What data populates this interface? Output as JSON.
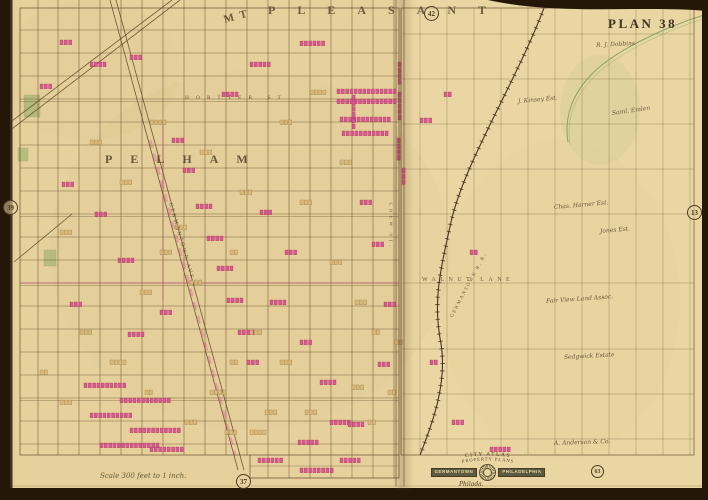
{
  "plate": {
    "number_label": "PLAN 38",
    "scale_note": "Scale 300 feet to 1 inch.",
    "imprint": "Philada.",
    "adjacent": {
      "top": "42",
      "left": "39",
      "right": "13",
      "bottom_left": "37",
      "bottom_right": "63"
    }
  },
  "districts": {
    "mt_prefix": "MT",
    "pleasant": "PLEASANT",
    "pelham": "PELHAM"
  },
  "cartouche": {
    "arch_top": "CITY ATLAS",
    "arch_bottom": "PROPERTY PLANS",
    "ribbon_left": "GERMANTOWN",
    "ribbon_right": "PHILADELPHIA"
  },
  "street_labels": [
    {
      "t": "HORTTER ST",
      "x": 185,
      "y": 95,
      "r": 0,
      "fs": 5.5,
      "ls": 7
    },
    {
      "t": "WALNUT LANE",
      "x": 422,
      "y": 277,
      "r": 0,
      "fs": 6,
      "ls": 4.5
    },
    {
      "t": "GERMANTOWN AVE.",
      "x": 170,
      "y": 200,
      "r": 74,
      "fs": 5.5,
      "ls": 2
    },
    {
      "t": "CHEW ST.",
      "x": 390,
      "y": 200,
      "r": 90,
      "fs": 5,
      "ls": 3
    },
    {
      "t": "GERMANTOWN R. R.",
      "x": 452,
      "y": 315,
      "r": -62,
      "fs": 5,
      "ls": 1.5
    }
  ],
  "estate_labels": [
    {
      "t": "R. J. Dobbins",
      "x": 596,
      "y": 42,
      "r": -3
    },
    {
      "t": "J. Kinsey Est.",
      "x": 518,
      "y": 98,
      "r": -5
    },
    {
      "t": "Saml. Emlen",
      "x": 612,
      "y": 110,
      "r": -8
    },
    {
      "t": "Chas. Harner Est.",
      "x": 554,
      "y": 204,
      "r": -5
    },
    {
      "t": "Jones Est.",
      "x": 600,
      "y": 228,
      "r": -5
    },
    {
      "t": "Fair View Land Assoc.",
      "x": 546,
      "y": 298,
      "r": -4
    },
    {
      "t": "Sedgwick Estate",
      "x": 564,
      "y": 354,
      "r": -3
    },
    {
      "t": "A. Anderson & Co.",
      "x": 554,
      "y": 440,
      "r": -2
    }
  ],
  "colors": {
    "paper": "#e9d6a3",
    "paper_left": "#e3cd96",
    "ink": "#5a4226",
    "ink_light": "#8a7148",
    "pink": "#d84f97",
    "pink_edge": "#a02340",
    "tan_bldg": "#d9b878",
    "tan_edge": "#8a6a37",
    "green": "#7fa45b",
    "dark": "#241708",
    "rail": "#3d2c18"
  },
  "geometry": {
    "left_grid": {
      "vx": [
        38,
        58,
        79,
        100,
        121,
        142,
        163,
        184,
        205,
        226,
        247,
        268,
        289,
        310,
        331,
        352,
        373,
        394
      ],
      "hy": [
        30,
        53,
        76,
        99,
        122,
        145,
        168,
        191,
        214,
        237,
        260,
        283,
        306,
        329,
        352,
        375,
        398,
        421,
        444
      ],
      "x0": 20,
      "x1": 399,
      "y0": 0,
      "y1": 455,
      "majors": [
        99,
        214,
        283,
        398
      ],
      "ext_vx": [
        268,
        289,
        310,
        331,
        352,
        373,
        394
      ]
    },
    "right_grid": {
      "vx": [
        420,
        447,
        474,
        501,
        528,
        555,
        582,
        609,
        636,
        663,
        690
      ],
      "hy": [
        34,
        79,
        124,
        169,
        214,
        283,
        349,
        394,
        439
      ],
      "x0": 402,
      "x1": 694,
      "y0": 8,
      "y1": 455
    },
    "diagonals": [
      [
        110,
        0,
        238,
        470
      ],
      [
        116,
        0,
        244,
        470
      ],
      [
        0,
        130,
        172,
        0
      ],
      [
        0,
        138,
        180,
        0
      ],
      [
        14,
        262,
        72,
        214
      ]
    ],
    "avenue_tint": [
      150,
      140,
      235,
      455
    ],
    "railroad": "M547,0 C518,80 465,160 451,222 C439,276 433,303 441,344 C448,386 429,432 420,455",
    "creek": "M707,14 C662,28 612,52 590,76 C572,95 564,118 568,142",
    "greens": [
      [
        24,
        95,
        16,
        22
      ],
      [
        44,
        250,
        12,
        16
      ],
      [
        18,
        148,
        10,
        13
      ]
    ],
    "blocks": {
      "p": [
        [
          337,
          89,
          14
        ],
        [
          337,
          99,
          14
        ],
        [
          340,
          117,
          12
        ],
        [
          342,
          131,
          11
        ],
        [
          300,
          41,
          6
        ],
        [
          250,
          62,
          5
        ],
        [
          222,
          92,
          4
        ],
        [
          172,
          138,
          3
        ],
        [
          183,
          168,
          3
        ],
        [
          196,
          204,
          4
        ],
        [
          207,
          236,
          4
        ],
        [
          217,
          266,
          4
        ],
        [
          227,
          298,
          4
        ],
        [
          238,
          330,
          4
        ],
        [
          247,
          360,
          3
        ],
        [
          84,
          383,
          10
        ],
        [
          120,
          398,
          12
        ],
        [
          90,
          413,
          10
        ],
        [
          130,
          428,
          12
        ],
        [
          100,
          443,
          14
        ],
        [
          150,
          447,
          8
        ],
        [
          62,
          182,
          3
        ],
        [
          95,
          212,
          3
        ],
        [
          118,
          258,
          4
        ],
        [
          70,
          302,
          3
        ],
        [
          128,
          332,
          4
        ],
        [
          160,
          310,
          3
        ],
        [
          260,
          210,
          3
        ],
        [
          285,
          250,
          3
        ],
        [
          270,
          300,
          4
        ],
        [
          300,
          340,
          3
        ],
        [
          320,
          380,
          4
        ],
        [
          330,
          420,
          5
        ],
        [
          360,
          200,
          3
        ],
        [
          372,
          242,
          3
        ],
        [
          384,
          302,
          3
        ],
        [
          378,
          362,
          3
        ],
        [
          348,
          422,
          4
        ],
        [
          298,
          440,
          5
        ],
        [
          60,
          40,
          3
        ],
        [
          90,
          62,
          4
        ],
        [
          40,
          84,
          3
        ],
        [
          130,
          55,
          3
        ],
        [
          420,
          118,
          3
        ],
        [
          444,
          92,
          2
        ],
        [
          470,
          250,
          2
        ],
        [
          430,
          360,
          2
        ],
        [
          452,
          420,
          3
        ],
        [
          490,
          447,
          5
        ],
        [
          258,
          458,
          6
        ],
        [
          300,
          468,
          8
        ],
        [
          340,
          458,
          5
        ]
      ],
      "pv": [
        [
          352,
          95,
          6
        ],
        [
          398,
          62,
          4
        ],
        [
          398,
          92,
          5
        ],
        [
          397,
          138,
          4
        ],
        [
          402,
          168,
          3
        ]
      ],
      "t": [
        [
          150,
          120,
          4
        ],
        [
          200,
          150,
          3
        ],
        [
          240,
          190,
          3
        ],
        [
          90,
          140,
          3
        ],
        [
          60,
          230,
          3
        ],
        [
          110,
          360,
          4
        ],
        [
          210,
          390,
          4
        ],
        [
          250,
          430,
          4
        ],
        [
          310,
          90,
          4
        ],
        [
          280,
          120,
          3
        ],
        [
          340,
          160,
          3
        ],
        [
          355,
          300,
          3
        ],
        [
          330,
          260,
          3
        ],
        [
          300,
          200,
          3
        ],
        [
          160,
          250,
          3
        ],
        [
          140,
          290,
          3
        ],
        [
          190,
          280,
          3
        ],
        [
          230,
          250,
          2
        ],
        [
          175,
          225,
          3
        ],
        [
          120,
          180,
          3
        ],
        [
          80,
          330,
          3
        ],
        [
          60,
          400,
          3
        ],
        [
          40,
          370,
          2
        ],
        [
          250,
          330,
          3
        ],
        [
          280,
          360,
          3
        ],
        [
          230,
          360,
          2
        ],
        [
          305,
          410,
          3
        ],
        [
          265,
          410,
          3
        ],
        [
          225,
          430,
          3
        ],
        [
          185,
          420,
          3
        ],
        [
          145,
          390,
          2
        ],
        [
          352,
          385,
          3
        ],
        [
          368,
          420,
          2
        ],
        [
          388,
          390,
          2
        ],
        [
          395,
          340,
          2
        ],
        [
          372,
          330,
          2
        ]
      ]
    }
  }
}
